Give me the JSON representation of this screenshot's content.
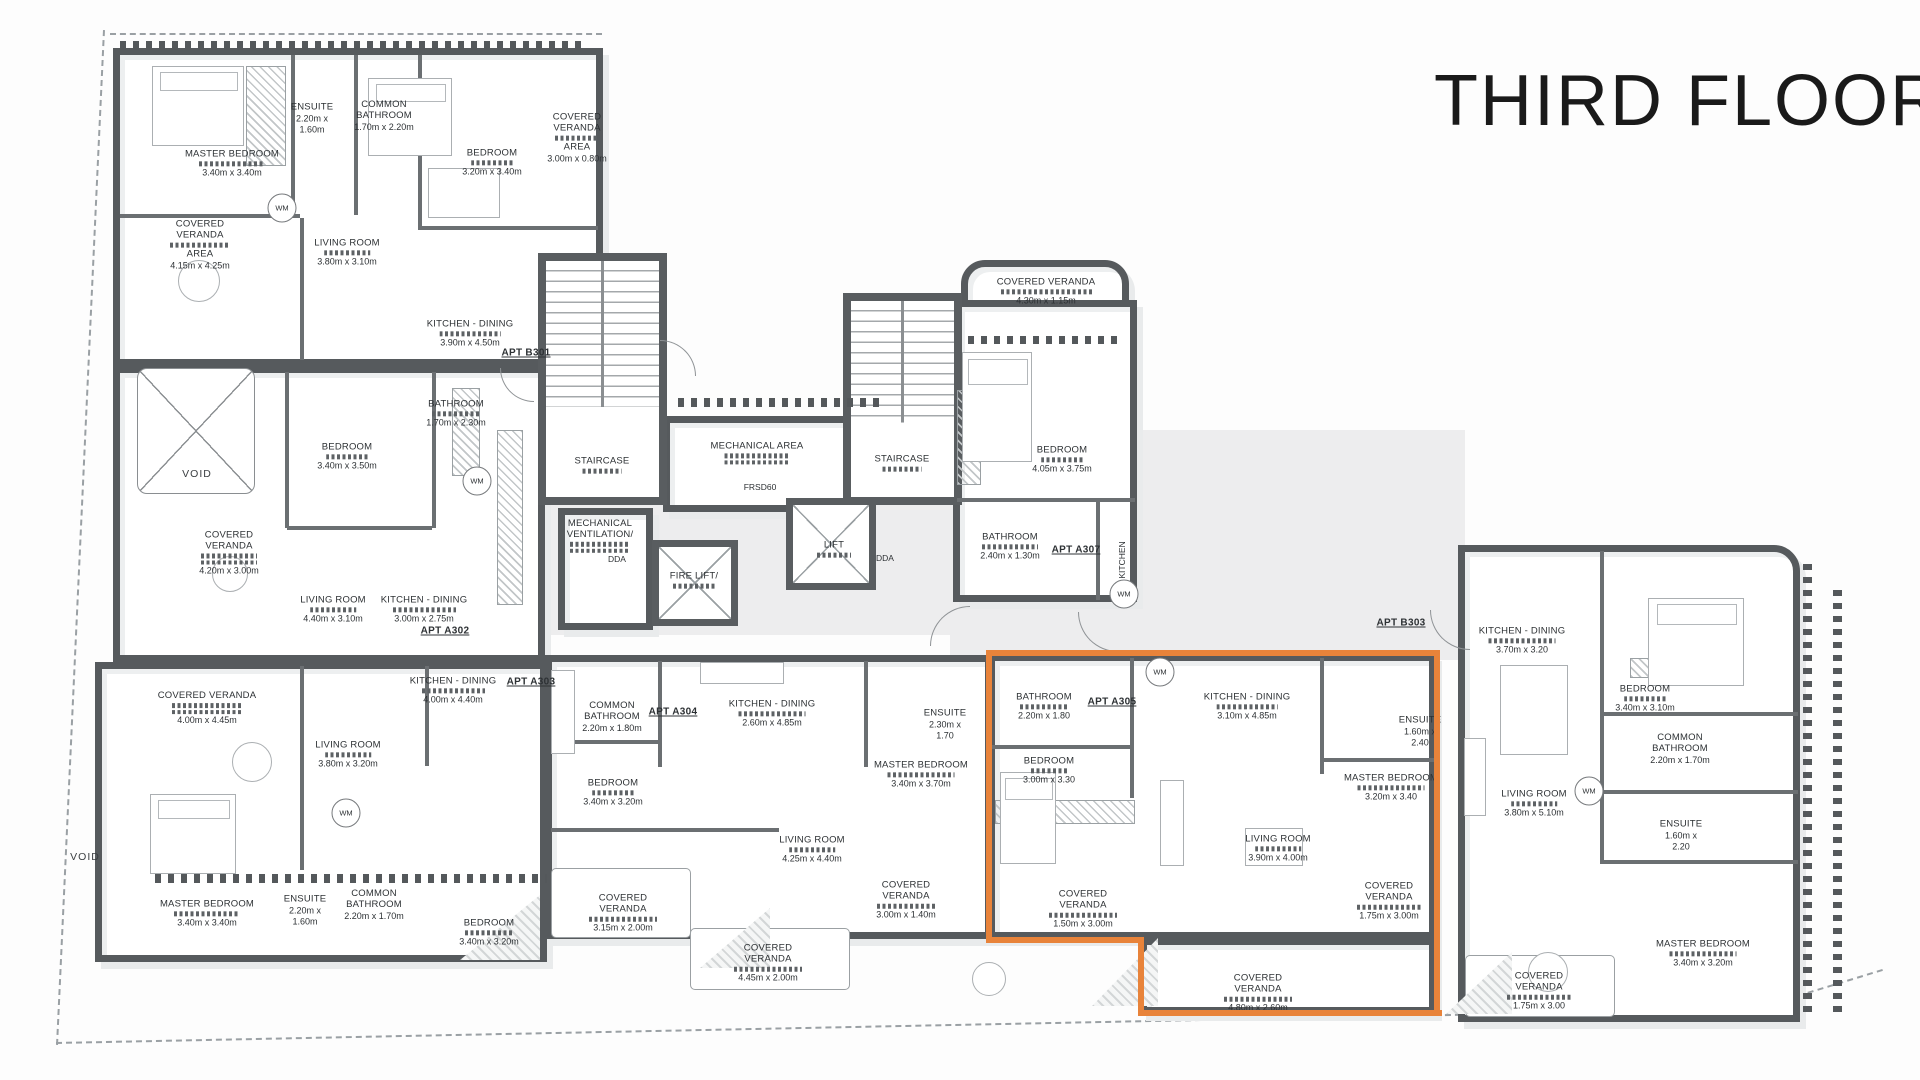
{
  "title": "THIRD FLOOR",
  "highlight": {
    "color": "#E8833A",
    "apartment": "APT A305"
  },
  "apartment_labels": [
    {
      "t": "APT B301",
      "x": 526,
      "y": 353
    },
    {
      "t": "APT A302",
      "x": 445,
      "y": 631
    },
    {
      "t": "APT A303",
      "x": 531,
      "y": 682
    },
    {
      "t": "APT A304",
      "x": 673,
      "y": 712
    },
    {
      "t": "APT A305",
      "x": 1112,
      "y": 702
    },
    {
      "t": "APT A307",
      "x": 1076,
      "y": 550
    },
    {
      "t": "APT B303",
      "x": 1401,
      "y": 623
    }
  ],
  "rooms": [
    {
      "apt": "B301",
      "n": "MASTER BEDROOM",
      "d": "3.40m x 3.40m",
      "x": 232,
      "y": 163,
      "g": 1
    },
    {
      "apt": "B301",
      "n": "ENSUITE",
      "d": "2.20m x 1.60m",
      "x": 312,
      "y": 118,
      "w": 52
    },
    {
      "apt": "B301",
      "n": "COMMON BATHROOM",
      "d": "1.70m x 2.20m",
      "x": 384,
      "y": 116,
      "w": 80
    },
    {
      "apt": "B301",
      "n": "BEDROOM",
      "d": "3.20m x 3.40m",
      "x": 492,
      "y": 162,
      "g": 1
    },
    {
      "apt": "B301",
      "n": "COVERED VERANDA",
      "n2": "AREA",
      "d": "4.15m x 4.25m",
      "x": 200,
      "y": 245,
      "g": 1,
      "w": 86
    },
    {
      "apt": "B301",
      "n": "LIVING ROOM",
      "d": "3.80m x 3.10m",
      "x": 347,
      "y": 252,
      "g": 1
    },
    {
      "apt": "B301",
      "n": "KITCHEN - DINING",
      "d": "3.90m x 4.50m",
      "x": 470,
      "y": 333,
      "g": 1
    },
    {
      "apt": "B301",
      "n": "COVERED VERANDA",
      "n2": "AREA",
      "d": "3.00m x 0.80m",
      "x": 577,
      "y": 138,
      "g": 1,
      "w": 64
    },
    {
      "apt": "A302",
      "n": "BEDROOM",
      "d": "3.40m x 3.50m",
      "x": 347,
      "y": 456,
      "g": 1
    },
    {
      "apt": "A302",
      "n": "BATHROOM",
      "d": "1.70m x 2.30m",
      "x": 456,
      "y": 413,
      "g": 1,
      "w": 70
    },
    {
      "apt": "A302",
      "n": "COVERED VERANDA",
      "d": "4.20m x 3.00m",
      "x": 229,
      "y": 553,
      "g": 2,
      "w": 80
    },
    {
      "apt": "A302",
      "n": "LIVING ROOM",
      "d": "4.40m x 3.10m",
      "x": 333,
      "y": 609,
      "g": 1
    },
    {
      "apt": "A302",
      "n": "KITCHEN - DINING",
      "d": "3.00m x 2.75m",
      "x": 424,
      "y": 609,
      "g": 1,
      "w": 90
    },
    {
      "apt": "A303",
      "n": "COVERED VERANDA",
      "d": "4.00m x 4.45m",
      "x": 207,
      "y": 708,
      "g": 2,
      "w": 100
    },
    {
      "apt": "A303",
      "n": "LIVING ROOM",
      "d": "3.80m x 3.20m",
      "x": 348,
      "y": 754,
      "g": 1
    },
    {
      "apt": "A303",
      "n": "KITCHEN - DINING",
      "d": "4.00m x 4.40m",
      "x": 453,
      "y": 690,
      "g": 1,
      "w": 90
    },
    {
      "apt": "A303",
      "n": "MASTER BEDROOM",
      "d": "3.40m x 3.40m",
      "x": 207,
      "y": 913,
      "g": 1
    },
    {
      "apt": "A303",
      "n": "ENSUITE",
      "d": "2.20m x 1.60m",
      "x": 305,
      "y": 910,
      "w": 52
    },
    {
      "apt": "A303",
      "n": "COMMON BATHROOM",
      "d": "2.20m x 1.70m",
      "x": 374,
      "y": 905,
      "w": 78
    },
    {
      "apt": "A303",
      "n": "BEDROOM",
      "d": "3.40m x 3.20m",
      "x": 489,
      "y": 932,
      "g": 1,
      "w": 70
    },
    {
      "apt": "A304",
      "n": "COMMON BATHROOM",
      "d": "2.20m x 1.80m",
      "x": 612,
      "y": 717,
      "w": 78
    },
    {
      "apt": "A304",
      "n": "BEDROOM",
      "d": "3.40m x 3.20m",
      "x": 613,
      "y": 792,
      "g": 1
    },
    {
      "apt": "A304",
      "n": "KITCHEN - DINING",
      "d": "2.60m x 4.85m",
      "x": 772,
      "y": 713,
      "g": 1,
      "w": 95
    },
    {
      "apt": "A304",
      "n": "LIVING ROOM",
      "d": "4.25m x 4.40m",
      "x": 812,
      "y": 849,
      "g": 1
    },
    {
      "apt": "A304",
      "n": "MASTER BEDROOM",
      "d": "3.40m x 3.70m",
      "x": 921,
      "y": 774,
      "g": 1,
      "w": 95
    },
    {
      "apt": "A304",
      "n": "ENSUITE",
      "d": "2.30m x 1.70",
      "x": 945,
      "y": 724,
      "w": 50
    },
    {
      "apt": "A304",
      "n": "COVERED VERANDA",
      "d": "3.15m x 2.00m",
      "x": 623,
      "y": 913,
      "g": 1,
      "w": 98
    },
    {
      "apt": "A304",
      "n": "COVERED VERANDA",
      "d": "4.45m x 2.00m",
      "x": 768,
      "y": 963,
      "g": 1,
      "w": 98
    },
    {
      "apt": "A304",
      "n": "COVERED VERANDA",
      "d": "3.00m x 1.40m",
      "x": 906,
      "y": 900,
      "g": 1,
      "w": 82
    },
    {
      "apt": "A305",
      "n": "BATHROOM",
      "d": "2.20m x 1.80",
      "x": 1044,
      "y": 706,
      "g": 1,
      "w": 70
    },
    {
      "apt": "A305",
      "n": "BEDROOM",
      "d": "3.00m x 3.30",
      "x": 1049,
      "y": 770,
      "g": 1
    },
    {
      "apt": "A305",
      "n": "KITCHEN - DINING",
      "d": "3.10m x 4.85m",
      "x": 1247,
      "y": 706,
      "g": 1
    },
    {
      "apt": "A305",
      "n": "MASTER BEDROOM",
      "d": "3.20m x 3.40",
      "x": 1391,
      "y": 787,
      "g": 1,
      "w": 95
    },
    {
      "apt": "A305",
      "n": "ENSUITE",
      "d": "1.60m x 2.40",
      "x": 1420,
      "y": 731,
      "w": 50
    },
    {
      "apt": "A305",
      "n": "LIVING ROOM",
      "d": "3.90m x 4.00m",
      "x": 1278,
      "y": 848,
      "g": 1
    },
    {
      "apt": "A305",
      "n": "COVERED VERANDA",
      "d": "1.50m x 3.00m",
      "x": 1083,
      "y": 909,
      "g": 1,
      "w": 98
    },
    {
      "apt": "A305",
      "n": "COVERED VERANDA",
      "d": "1.75m x 3.00m",
      "x": 1389,
      "y": 901,
      "g": 1,
      "w": 92
    },
    {
      "apt": "A305",
      "n": "COVERED VERANDA",
      "d": "4.80m x 2.60m",
      "x": 1258,
      "y": 993,
      "g": 1,
      "w": 98
    },
    {
      "apt": "A307",
      "n": "COVERED VERANDA",
      "d": "4.30m x 1.15m",
      "x": 1046,
      "y": 291,
      "g": 1,
      "w": 130
    },
    {
      "apt": "A307",
      "n": "BEDROOM",
      "d": "4.05m x 3.75m",
      "x": 1062,
      "y": 459,
      "g": 1
    },
    {
      "apt": "A307",
      "n": "BATHROOM",
      "d": "2.40m x 1.30m",
      "x": 1010,
      "y": 546,
      "g": 1,
      "w": 80
    },
    {
      "apt": "B303",
      "n": "KITCHEN - DINING",
      "d": "3.70m x 3.20",
      "x": 1522,
      "y": 640,
      "g": 1,
      "w": 95
    },
    {
      "apt": "B303",
      "n": "BEDROOM",
      "d": "3.40m x 3.10m",
      "x": 1645,
      "y": 698,
      "g": 1
    },
    {
      "apt": "B303",
      "n": "COMMON BATHROOM",
      "d": "2.20m x 1.70m",
      "x": 1680,
      "y": 749,
      "w": 80
    },
    {
      "apt": "B303",
      "n": "LIVING ROOM",
      "d": "3.80m x 5.10m",
      "x": 1534,
      "y": 803,
      "g": 1
    },
    {
      "apt": "B303",
      "n": "ENSUITE",
      "d": "1.60m x 2.20",
      "x": 1681,
      "y": 835,
      "w": 50
    },
    {
      "apt": "B303",
      "n": "MASTER BEDROOM",
      "d": "3.40m x 3.20m",
      "x": 1703,
      "y": 953,
      "g": 1,
      "w": 95
    },
    {
      "apt": "B303",
      "n": "COVERED VERANDA",
      "d": "1.75m x 3.00",
      "x": 1539,
      "y": 991,
      "g": 1,
      "w": 92
    }
  ],
  "core_labels": [
    {
      "t": "STAIRCASE",
      "x": 602,
      "y": 465,
      "g": 1
    },
    {
      "t": "STAIRCASE",
      "x": 902,
      "y": 463,
      "g": 1
    },
    {
      "t": "MECHANICAL AREA",
      "x": 757,
      "y": 453,
      "g": 2
    },
    {
      "t": "MECHANICAL VENTILATION/",
      "x": 600,
      "y": 536,
      "g": 2,
      "w": 86
    },
    {
      "t": "FIRE LIFT/",
      "x": 694,
      "y": 580,
      "g": 1,
      "w": 60
    },
    {
      "t": "LIFT",
      "x": 834,
      "y": 549,
      "g": 1
    }
  ],
  "small_labels": [
    {
      "t": "WM",
      "x": 282,
      "y": 208,
      "c": 1
    },
    {
      "t": "WM",
      "x": 477,
      "y": 481,
      "c": 1
    },
    {
      "t": "WM",
      "x": 346,
      "y": 813,
      "c": 1
    },
    {
      "t": "WM",
      "x": 1124,
      "y": 594,
      "c": 1
    },
    {
      "t": "WM",
      "x": 1160,
      "y": 672,
      "c": 1
    },
    {
      "t": "WM",
      "x": 1589,
      "y": 791,
      "c": 1
    },
    {
      "t": "DDA",
      "x": 617,
      "y": 559
    },
    {
      "t": "DDA",
      "x": 885,
      "y": 558
    },
    {
      "t": "FRSD60",
      "x": 760,
      "y": 487
    },
    {
      "t": "KITCHEN",
      "x": 1122,
      "y": 560,
      "v": 1
    },
    {
      "t": "VOID",
      "x": 197,
      "y": 474,
      "big": 1
    },
    {
      "t": "VOID",
      "x": 85,
      "y": 857,
      "big": 1
    }
  ]
}
